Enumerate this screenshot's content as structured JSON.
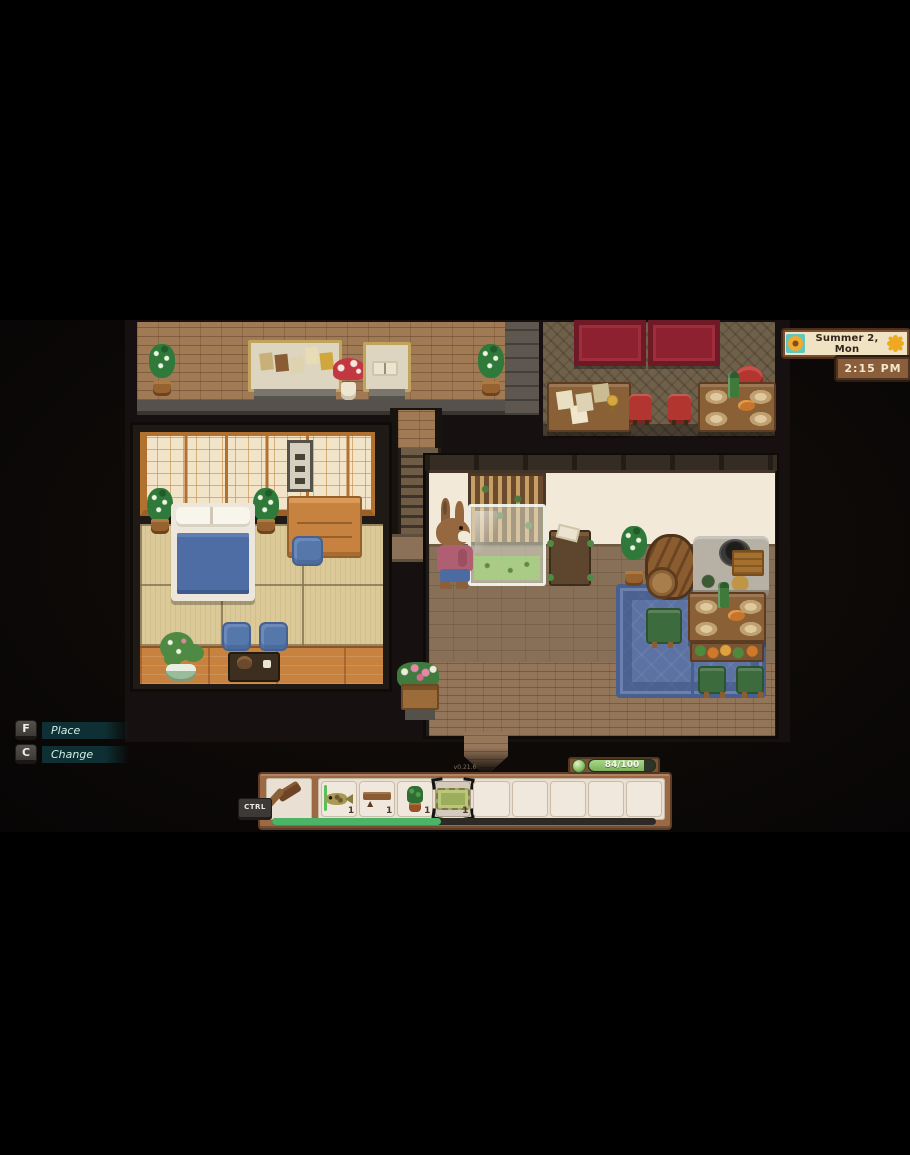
{
  "hud": {
    "date_panel": {
      "date": "Summer 2, Mon",
      "left_icon": "sunflower-icon",
      "right_icon": "sun-icon"
    },
    "time_panel": {
      "time": "2:15 PM"
    },
    "keybinds": {
      "place": {
        "key": "F",
        "label": "Place"
      },
      "change": {
        "key": "C",
        "label": "Change"
      }
    },
    "energy": {
      "value": "84/100",
      "percent": 84,
      "icon": "energy-orb-icon"
    },
    "modifier_key": "CTRL",
    "version_text": "v0.21.6",
    "hotbar": {
      "tool_slot": {
        "item": "hammer"
      },
      "selected_index": 3,
      "progress_percent": 44,
      "slots": [
        {
          "item": "fish",
          "count": "1"
        },
        {
          "item": "wooden-bench",
          "count": "1"
        },
        {
          "item": "potted-plant",
          "count": "1"
        },
        {
          "item": "green-rug",
          "count": "1"
        },
        {
          "item": "",
          "count": ""
        },
        {
          "item": "",
          "count": ""
        },
        {
          "item": "",
          "count": ""
        },
        {
          "item": "",
          "count": ""
        },
        {
          "item": "",
          "count": ""
        }
      ]
    }
  },
  "scene": {
    "character": {
      "name": "rabbit-villager",
      "outfit": "pink-sweater-blue-pants"
    },
    "rooms": [
      "museum-hall",
      "dining-hall",
      "tatami-bedroom",
      "main-hall-kitchen"
    ]
  },
  "colors": {
    "hud_panel_brown": "#8a5d3b",
    "hud_panel_cream": "#efe3c4",
    "hud_teal_strip": "#0e3034",
    "energy_green": "#8cc56a",
    "progress_green": "#4cb467",
    "tapestry_red": "#8e2130",
    "rug_blue": "#5b72a3",
    "shoji_orange": "#b3712f",
    "tatami_beige": "#dcc998"
  }
}
